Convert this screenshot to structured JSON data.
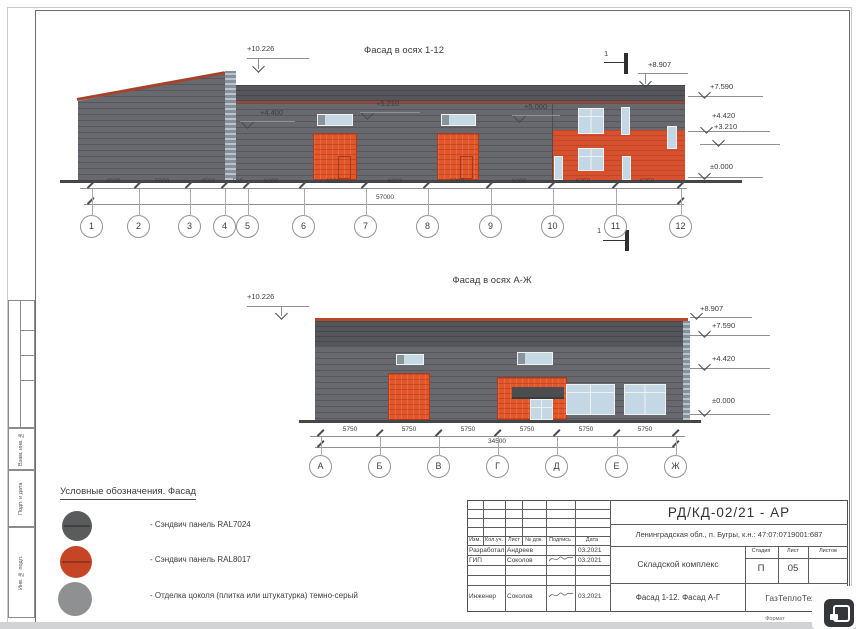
{
  "sheet": {
    "facade1": {
      "title": "Фасад в осях 1-12",
      "lvl_10226": "+10.226",
      "lvl_8907": "+8.907",
      "lvl_7590": "+7.590",
      "lvl_4420": "+4.420",
      "lvl_3210": "+3.210",
      "lvl_0000": "±0.000",
      "lvl_4400": "+4.400",
      "lvl_5210": "+5.210",
      "lvl_5000": "+5.000",
      "section_mark": "1",
      "dims": [
        "4500",
        "5000",
        "4500",
        "500",
        "6000",
        "6000",
        "6003",
        "6000",
        "6000",
        "6250",
        "6250"
      ],
      "total": "57000",
      "axes": [
        "1",
        "2",
        "3",
        "4",
        "5",
        "6",
        "7",
        "8",
        "9",
        "10",
        "11",
        "12"
      ]
    },
    "facade2": {
      "title": "Фасад в осях А-Ж",
      "lvl_10226": "+10.226",
      "lvl_8907": "+8.907",
      "lvl_7590": "+7.590",
      "lvl_4420": "+4.420",
      "lvl_0000": "±0.000",
      "dims": [
        "5750",
        "5750",
        "5750",
        "5750",
        "5750",
        "5750"
      ],
      "total": "34500",
      "axes": [
        "А",
        "Б",
        "В",
        "Г",
        "Д",
        "Е",
        "Ж"
      ]
    },
    "legend": {
      "title": "Условные обозначения. Фасад",
      "items": [
        {
          "swatch": "#595b5d",
          "label": "- Сэндвич панель  RAL7024"
        },
        {
          "swatch": "#c74527",
          "label": "- Сэндвич панель  RAL8017"
        },
        {
          "swatch": "#8e9092",
          "label": "- Отделка цоколя (плитка или штукатурка) темно-серый"
        }
      ]
    },
    "stamp": {
      "doc": "РД/КД-02/21 - АР",
      "location": "Ленинградская обл., п. Бугры, к.н.: 47:07:0719001:687",
      "object": "Складской комплекс",
      "drawing": "Фасад 1-12. Фасад А-Г",
      "company": "ГазТеплоТехно",
      "cols": {
        "izm": "Изм.",
        "kol": "Кол.уч.",
        "list": "Лист",
        "doc": "№ док.",
        "sign": "Подпись",
        "date": "Дата"
      },
      "rows": [
        {
          "role": "Разработал",
          "name": "Андреев",
          "date": "03.2021"
        },
        {
          "role": "ГИП",
          "name": "Соколов",
          "date": "03.2021"
        },
        {
          "role": "Инженер",
          "name": "Соколов",
          "date": "03.2021"
        }
      ],
      "stage_label": "Стадия",
      "list_label": "Лист",
      "listov_label": "Листов",
      "stage": "П",
      "list_no": "05",
      "format_label": "Формат"
    },
    "frame_labels": [
      "Взам. инв. №",
      "Подп. и дата",
      "Инв. № подл."
    ],
    "colors": {
      "wall_grey": "#67696e",
      "parapet_grey": "#54565b",
      "trim_red": "#a5422c",
      "panel_orange": "#e2562a",
      "glass_blue": "#c3d8e4"
    }
  }
}
